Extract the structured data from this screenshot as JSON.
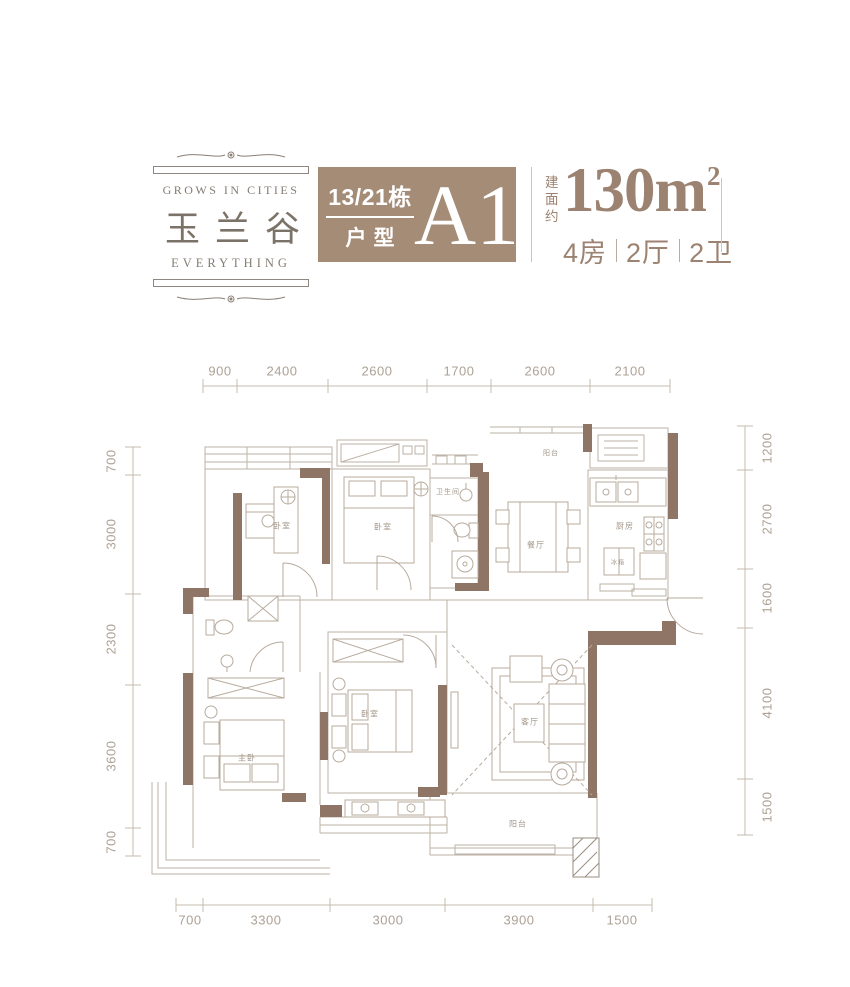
{
  "logo": {
    "tagline_top": "GROWS IN CITIES",
    "title": "玉兰谷",
    "tagline_bottom": "EVERYTHING"
  },
  "header": {
    "building_no": "13/21栋",
    "type_label": "户型",
    "unit_code": "A1",
    "area_label": "建面约",
    "area_number": "130",
    "area_unit": "m",
    "area_exponent": "2",
    "layout_parts": [
      "4房",
      "2厅",
      "2卫"
    ]
  },
  "colors": {
    "brand_brown": "#a58c77",
    "wall_brown": "#8f7565",
    "thin_line": "#bdb2a6",
    "dim_text": "#ada195",
    "accent_text": "#9c8270"
  },
  "dimensions": {
    "top": [
      "900",
      "2400",
      "2600",
      "1700",
      "2600",
      "2100"
    ],
    "bottom": [
      "700",
      "3300",
      "3000",
      "3900",
      "1500"
    ],
    "left": [
      "700",
      "3000",
      "2300",
      "3600",
      "700"
    ],
    "right": [
      "1200",
      "2700",
      "1600",
      "4100",
      "1500"
    ]
  },
  "plan": {
    "dim_labels": [
      {
        "t": "900",
        "x": 220,
        "y": 371
      },
      {
        "t": "2400",
        "x": 282,
        "y": 371
      },
      {
        "t": "2600",
        "x": 377,
        "y": 371
      },
      {
        "t": "1700",
        "x": 459,
        "y": 371
      },
      {
        "t": "2600",
        "x": 540,
        "y": 371
      },
      {
        "t": "2100",
        "x": 630,
        "y": 371
      },
      {
        "t": "700",
        "x": 190,
        "y": 920
      },
      {
        "t": "3300",
        "x": 266,
        "y": 920
      },
      {
        "t": "3000",
        "x": 388,
        "y": 920
      },
      {
        "t": "3900",
        "x": 519,
        "y": 920
      },
      {
        "t": "1500",
        "x": 622,
        "y": 920
      },
      {
        "t": "700",
        "x": 111,
        "y": 461,
        "rot": 1
      },
      {
        "t": "3000",
        "x": 111,
        "y": 534,
        "rot": 1
      },
      {
        "t": "2300",
        "x": 111,
        "y": 639,
        "rot": 1
      },
      {
        "t": "3600",
        "x": 111,
        "y": 756,
        "rot": 1
      },
      {
        "t": "700",
        "x": 111,
        "y": 842,
        "rot": 1
      },
      {
        "t": "1200",
        "x": 767,
        "y": 448,
        "rot": 1
      },
      {
        "t": "2700",
        "x": 767,
        "y": 519,
        "rot": 1
      },
      {
        "t": "1600",
        "x": 767,
        "y": 598,
        "rot": 1
      },
      {
        "t": "4100",
        "x": 767,
        "y": 703,
        "rot": 1
      },
      {
        "t": "1500",
        "x": 767,
        "y": 807,
        "rot": 1
      }
    ],
    "room_labels": [
      {
        "t": "卧室",
        "x": 282,
        "y": 526
      },
      {
        "t": "卧室",
        "x": 383,
        "y": 527
      },
      {
        "t": "卫生间",
        "x": 448,
        "y": 492,
        "s": 7
      },
      {
        "t": "餐厅",
        "x": 536,
        "y": 545
      },
      {
        "t": "阳台",
        "x": 551,
        "y": 453,
        "s": 7
      },
      {
        "t": "厨房",
        "x": 625,
        "y": 526
      },
      {
        "t": "冰箱",
        "x": 618,
        "y": 562,
        "s": 6
      },
      {
        "t": "主卧",
        "x": 247,
        "y": 758
      },
      {
        "t": "卧室",
        "x": 370,
        "y": 714
      },
      {
        "t": "客厅",
        "x": 530,
        "y": 722
      },
      {
        "t": "阳台",
        "x": 518,
        "y": 824
      }
    ]
  }
}
